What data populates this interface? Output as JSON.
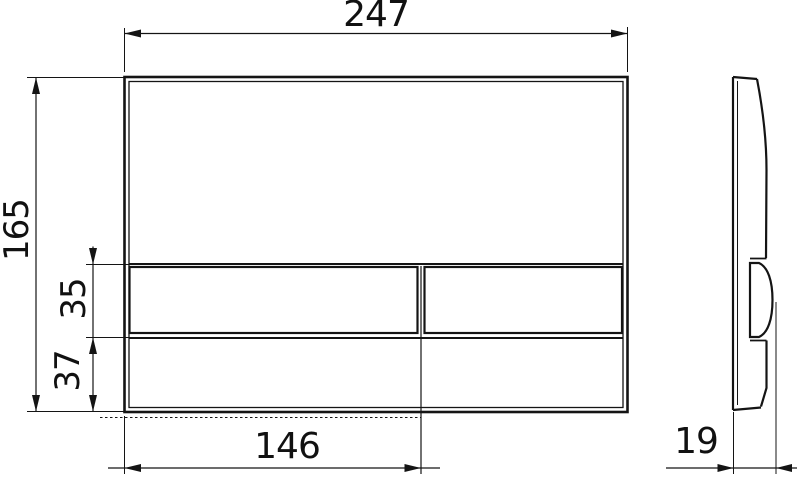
{
  "drawing": {
    "type": "technical-drawing",
    "subject": "wc-flush-plate-two-button",
    "background_color": "#ffffff",
    "line_color": "#141414",
    "views": {
      "front": "front-view",
      "side": "side-profile-view"
    },
    "dims": {
      "plate_width": {
        "value": "247",
        "orientation": "horizontal",
        "location": "top"
      },
      "plate_height": {
        "value": "165",
        "orientation": "vertical",
        "location": "left"
      },
      "button_row": {
        "value": "35",
        "orientation": "vertical",
        "location": "left-inner"
      },
      "lower_strip": {
        "value": "37",
        "orientation": "vertical",
        "location": "left-inner"
      },
      "big_button_width": {
        "value": "146",
        "orientation": "horizontal",
        "location": "bottom"
      },
      "plate_depth": {
        "value": "19",
        "orientation": "horizontal",
        "location": "bottom-right"
      }
    }
  }
}
